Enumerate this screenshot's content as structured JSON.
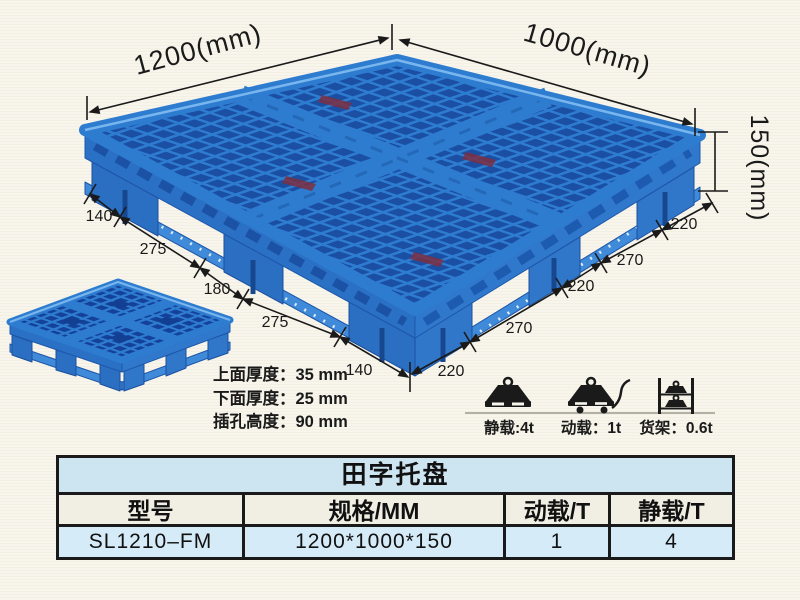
{
  "scene": {
    "length_label": "1200(mm)",
    "width_label": "1000(mm)",
    "height_label": "150(mm)",
    "bottom_left_chain": [
      "140",
      "275",
      "180",
      "275",
      "140"
    ],
    "bottom_right_chain": [
      "220",
      "270",
      "220",
      "270",
      "220"
    ]
  },
  "notes": {
    "top_thickness": "上面厚度：35 mm",
    "bottom_thickness": "下面厚度：25 mm",
    "fork_height": "插孔高度：90 mm"
  },
  "load_ratings": {
    "static": "静载:4t",
    "dynamic": "动载：1t",
    "rack": "货架：0.6t"
  },
  "table": {
    "title": "田字托盘",
    "headers": [
      "型号",
      "规格/MM",
      "动载/T",
      "静载/T"
    ],
    "rows": [
      [
        "SL1210–FM",
        "1200*1000*150",
        "1",
        "4"
      ]
    ]
  },
  "colors": {
    "pallet_blue": "#2e7cd0",
    "pallet_hole_blue": "#1a4fa4",
    "pallet_shadow_blue": "#1b52a5",
    "table_title_bg": "#cde4f1",
    "table_header_bg": "#f1eee4",
    "table_data_bg": "#d6ebf8",
    "ink": "#1a1a1a",
    "background": "#f8f6ec"
  }
}
